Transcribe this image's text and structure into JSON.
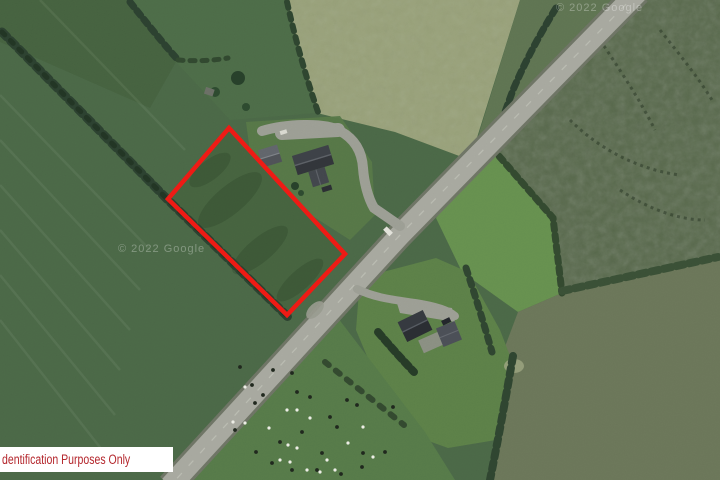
{
  "disclaimer": {
    "text": "dentification Purposes Only"
  },
  "watermarks": [
    {
      "text": "© 2022 Google",
      "x": 118,
      "y": 252
    },
    {
      "text": "© 2022 Google",
      "x": 556,
      "y": 11
    }
  ],
  "boundary": {
    "points": "229,128 168,199 287,315 345,254",
    "color": "#ee1b15",
    "stroke_width": 4.5
  },
  "cattle": {
    "animals": [
      [
        240,
        367,
        "b"
      ],
      [
        273,
        370,
        "b"
      ],
      [
        292,
        373,
        "b"
      ],
      [
        252,
        385,
        "b"
      ],
      [
        297,
        392,
        "b"
      ],
      [
        310,
        397,
        "b"
      ],
      [
        263,
        395,
        "b"
      ],
      [
        255,
        403,
        "b"
      ],
      [
        347,
        400,
        "b"
      ],
      [
        357,
        405,
        "b"
      ],
      [
        393,
        407,
        "b"
      ],
      [
        330,
        417,
        "b"
      ],
      [
        337,
        427,
        "b"
      ],
      [
        302,
        432,
        "b"
      ],
      [
        280,
        442,
        "b"
      ],
      [
        322,
        453,
        "b"
      ],
      [
        363,
        453,
        "b"
      ],
      [
        385,
        452,
        "b"
      ],
      [
        362,
        467,
        "b"
      ],
      [
        272,
        463,
        "b"
      ],
      [
        292,
        470,
        "b"
      ],
      [
        317,
        470,
        "b"
      ],
      [
        341,
        474,
        "b"
      ],
      [
        256,
        452,
        "b"
      ],
      [
        235,
        430,
        "b"
      ],
      [
        245,
        387,
        "w"
      ],
      [
        233,
        422,
        "w"
      ],
      [
        245,
        423,
        "w"
      ],
      [
        287,
        410,
        "w"
      ],
      [
        297,
        410,
        "w"
      ],
      [
        288,
        445,
        "w"
      ],
      [
        297,
        448,
        "w"
      ],
      [
        280,
        460,
        "w"
      ],
      [
        290,
        462,
        "w"
      ],
      [
        327,
        460,
        "w"
      ],
      [
        348,
        443,
        "w"
      ],
      [
        363,
        427,
        "w"
      ],
      [
        373,
        457,
        "w"
      ],
      [
        320,
        472,
        "w"
      ],
      [
        307,
        470,
        "w"
      ],
      [
        335,
        470,
        "w"
      ],
      [
        310,
        418,
        "w"
      ],
      [
        269,
        428,
        "w"
      ]
    ]
  },
  "colors": {
    "label_text": "#b4262c",
    "label_bg": "#ffffff",
    "watermark_fill": "rgba(255,255,255,0.30)",
    "cattle_dark": "#20281e",
    "cattle_light": "#edeee6"
  }
}
